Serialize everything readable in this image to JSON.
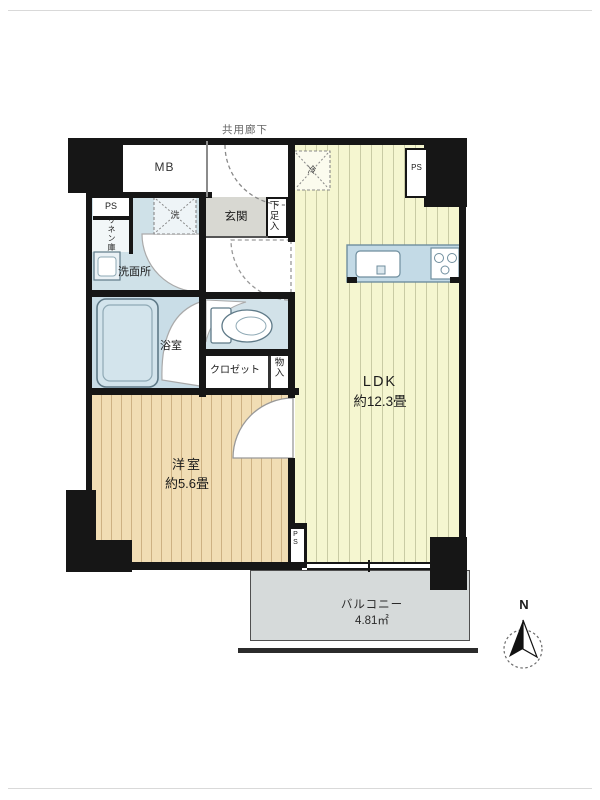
{
  "plan": {
    "corridor_label": "共用廊下",
    "mb": "MB",
    "ps": "PS",
    "linen": "リネン庫",
    "washer_mark": "洗",
    "fridge_mark": "冷",
    "genkan": "玄関",
    "shoe_box": "下足入",
    "washroom": "洗面所",
    "bathroom": "浴室",
    "closet": "クロゼット",
    "storage": "物入",
    "ldk": {
      "name": "LDK",
      "size": "約12.3畳"
    },
    "bedroom": {
      "name": "洋室",
      "size": "約5.6畳"
    },
    "balcony": {
      "name": "バルコニー",
      "size": "4.81㎡"
    },
    "north": "N",
    "colors": {
      "wall": "#161616",
      "ldk_floor": "#f5f6d0",
      "bedroom_floor": "#f1ddb4",
      "wet_area": "#cfe1e8",
      "genkan_tile": "#d8d8d2",
      "balcony": "#d6dada"
    }
  }
}
